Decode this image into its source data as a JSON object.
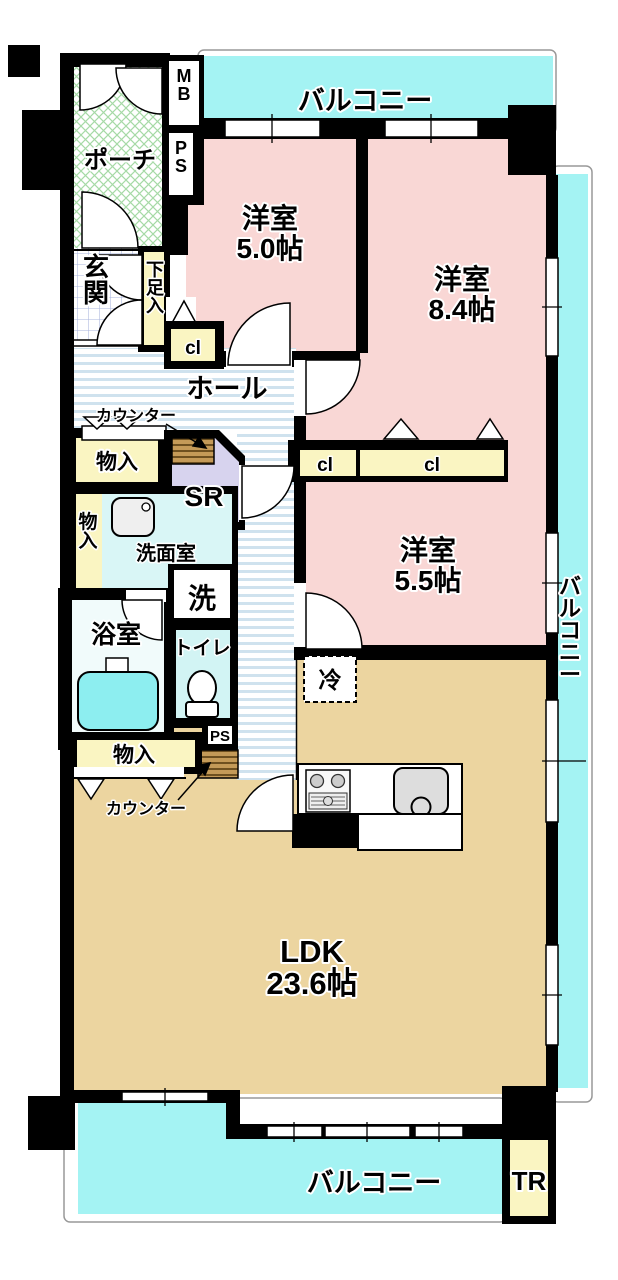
{
  "colors": {
    "wall": "#000000",
    "balcony": "#a4f3f3",
    "bedroom": "#f9d7d5",
    "ldk": "#ecd5a0",
    "closet_yellow": "#faf5c2",
    "sr_lavender": "#d7d3ee",
    "washroom_cyan": "#d9f6f6",
    "toilet_cyan": "#d2f4f4",
    "bathroom_bg": "#f1fbfb",
    "bathtub_cyan": "#8deef0",
    "porch_line": "#a6daa6",
    "genkan_line": "#aab4dd",
    "hall_stripe": "#cfe2ee",
    "counter_brown": "#c49a58",
    "counter_brown_dark": "#6e5020",
    "outline_gray": "#999999"
  },
  "rooms": {
    "balcony_top": {
      "label": "バルコニー"
    },
    "balcony_right": {
      "label": "バルコニー"
    },
    "balcony_bottom": {
      "label": "バルコニー"
    },
    "bedroom_a": {
      "name": "洋室",
      "size": "5.0帖"
    },
    "bedroom_b": {
      "name": "洋室",
      "size": "8.4帖"
    },
    "bedroom_c": {
      "name": "洋室",
      "size": "5.5帖"
    },
    "ldk": {
      "name": "LDK",
      "size": "23.6帖"
    },
    "hall": {
      "label": "ホール"
    },
    "porch": {
      "label": "ポーチ"
    },
    "entrance": {
      "label": "玄関"
    },
    "washroom": {
      "label": "洗面室"
    },
    "bathroom": {
      "label": "浴室"
    },
    "toilet": {
      "label": "トイレ"
    },
    "storage_room": {
      "label": "SR"
    },
    "trunk_room": {
      "label": "TR"
    }
  },
  "features": {
    "meter_box": "MB",
    "pipe_space_top": "PS",
    "pipe_space_bottom": "PS",
    "shoe_cabinet": "下足入",
    "closet_a": "cl",
    "closet_b": "cl",
    "closet_c": "cl",
    "storage_top": "物入",
    "storage_left": "物入",
    "storage_bottom": "物入",
    "counter_top": "カウンター",
    "counter_bottom": "カウンター",
    "washer": "洗",
    "refrigerator": "冷"
  }
}
